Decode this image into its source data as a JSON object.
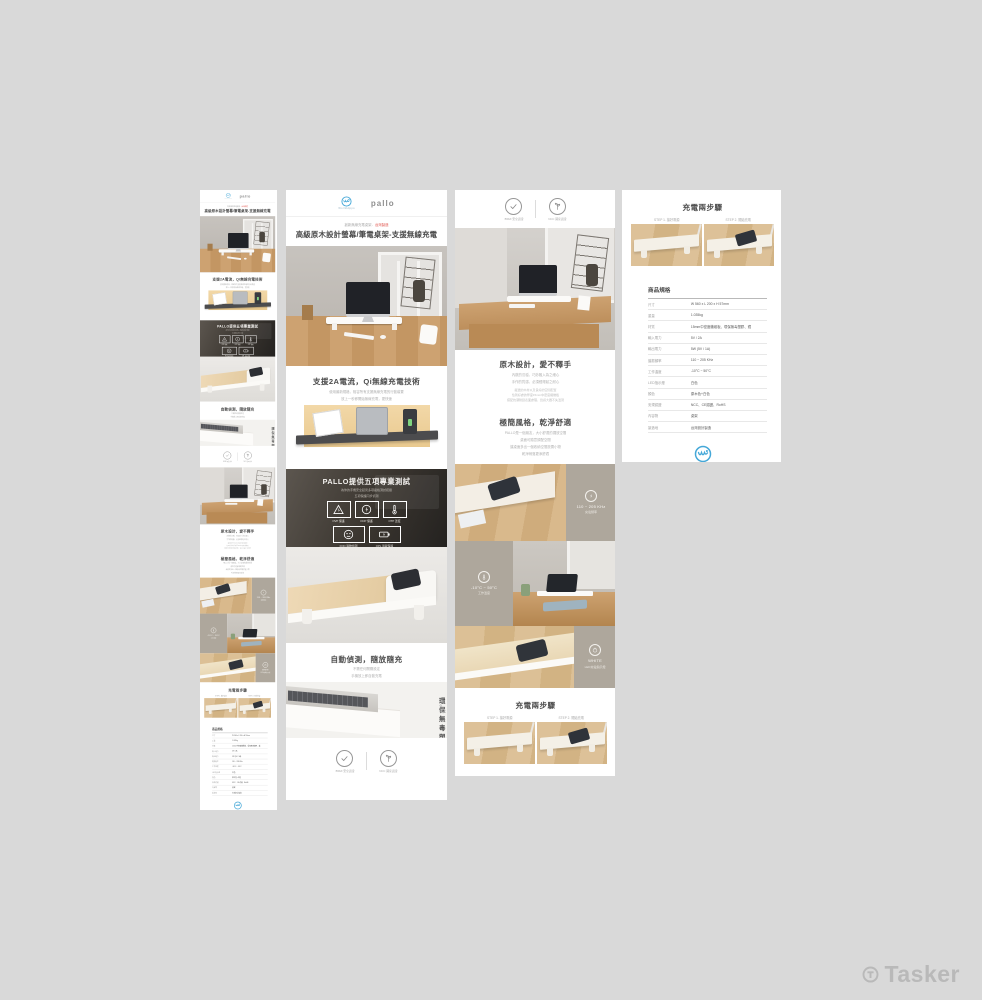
{
  "canvas": {
    "background": "#d9d9d9"
  },
  "brand": {
    "wordmark": "pallo",
    "logo_name": "WorldHippo",
    "logo_caption": "世 界 河 馬",
    "logo_color": "#45a8d8"
  },
  "hero": {
    "tagline_gray": "創新無線充電桌架．",
    "tagline_red": "台灣製造",
    "title": "高級原木設計螢幕/筆電桌架-支援無線充電"
  },
  "charge2a": {
    "title": "支援2A電流，Qi無線充電技術",
    "line1": "使用最新規格，相容所有支援無線充電的行動裝置",
    "line2": "放上一秒即開始無線充電，更快速"
  },
  "tests": {
    "title": "PALLO提供五項專業測試",
    "line1": "為你的手機安全起見多項嚴格測試把關",
    "line2": "五項保護同步偵測",
    "items": [
      "OVP 保護",
      "OCP 保護",
      "OTP 溫度",
      "FOD 異物偵測",
      "OPL 過載保護"
    ]
  },
  "auto": {
    "title": "自動偵測，隨放隨充",
    "line1": "不需任何開關設定",
    "line2": "手機放上即自動充電"
  },
  "eco": {
    "title": "環保無毒塑膠",
    "sub": "安全．環保"
  },
  "badges": {
    "left": "BSMI 安全認證",
    "right": "NCC 國家認證"
  },
  "wood": {
    "title": "原木設計，愛不釋手",
    "line1": "內斂的沉穩，巧妙融入為之細心",
    "line2": "手作的質感，必須經得起之耐心",
    "para1": "嚴選的木材以及良好的空間配置",
    "para2": "恰到好處的厚度15mm中密度纖維板",
    "para3": "搭配抗潮耐刮表面處理，質感大器不失溫潤"
  },
  "minimal": {
    "title": "極簡風格，乾淨舒適",
    "line1": "PALLO是一個朋友，大小舒適的擺放空間",
    "line2": "桌面可隨意調配空間",
    "line3": "讓桌面多出一個收納空間放置小物",
    "line4": "乾淨俐落更添舒適"
  },
  "tiles": {
    "freq": {
      "value": "110 ~ 205 KHz",
      "label": "充電頻率"
    },
    "temp": {
      "value": "-10°C ~ 50°C",
      "label": "工作溫度"
    },
    "led": {
      "value": "WHITE",
      "label": "LED充電指示燈"
    }
  },
  "steps": {
    "title": "充電兩步驟",
    "step1": "STEP 1. 接好電源",
    "step2": "STEP 2. 開始充電"
  },
  "spec": {
    "header": "商品規格",
    "rows": [
      {
        "label": "尺寸",
        "value": "W 560 x L 200 x H 57mm"
      },
      {
        "label": "重量",
        "value": "1.035kg"
      },
      {
        "label": "材質",
        "value": "15mm中密度纖維板、環保無毒塑膠、鐵"
      },
      {
        "label": "輸入電力",
        "value": "5V / 2A"
      },
      {
        "label": "輸出電力",
        "value": "5W (5V / 1A)"
      },
      {
        "label": "諧振頻率",
        "value": "110 ~ 205 KHz"
      },
      {
        "label": "工作溫度",
        "value": "-10°C ~ 50°C"
      },
      {
        "label": "LED指示燈",
        "value": "白色"
      },
      {
        "label": "顏色",
        "value": "原木色+白色"
      },
      {
        "label": "安規認證",
        "value": "NCC、CE認證、RoHS"
      },
      {
        "label": "內容物",
        "value": "桌架"
      },
      {
        "label": "製造地",
        "value": "台灣設計製造"
      }
    ]
  },
  "watermark": {
    "text": "Tasker"
  }
}
